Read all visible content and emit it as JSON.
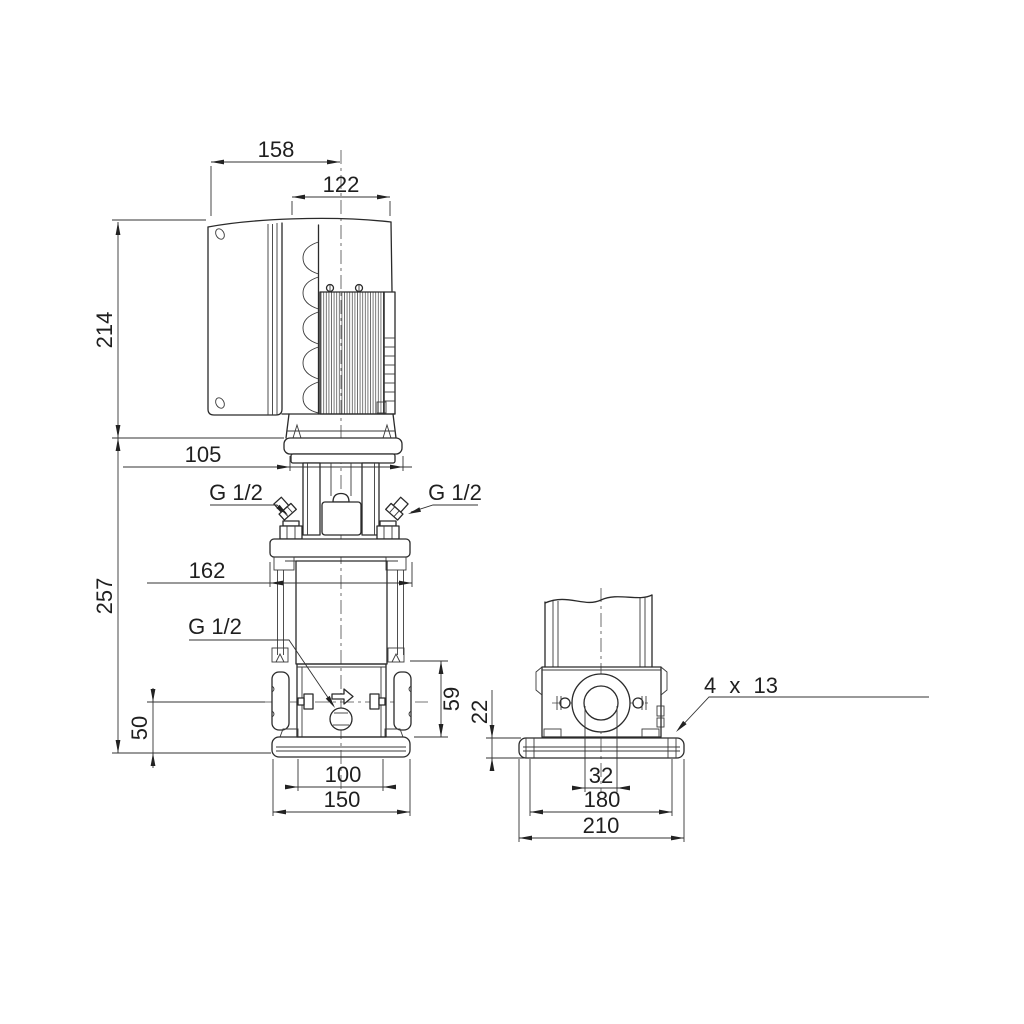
{
  "drawing": {
    "type": "technical-dimension-drawing",
    "subject": "vertical multistage centrifugal pump with motor, side view and end view",
    "units_note": "",
    "side_view": {
      "dimensions": {
        "overall_width": "158",
        "motor_width": "122",
        "motor_height": "214",
        "coupling_width": "105",
        "pump_height": "257",
        "flange_width": "162",
        "drain_height": "50",
        "chamber_height": "59",
        "base_inner_width": "100",
        "base_width": "150"
      },
      "port_labels": {
        "left": "G 1/2",
        "right": "G 1/2",
        "drain": "G 1/2"
      }
    },
    "end_view": {
      "dimensions": {
        "base_height": "22",
        "port_offset": "32",
        "bolt_spacing": "180",
        "base_depth": "210"
      },
      "mounting_holes_label": "4 x 13"
    },
    "colors": {
      "background": "#ffffff",
      "line": "#2a2a2a"
    }
  }
}
